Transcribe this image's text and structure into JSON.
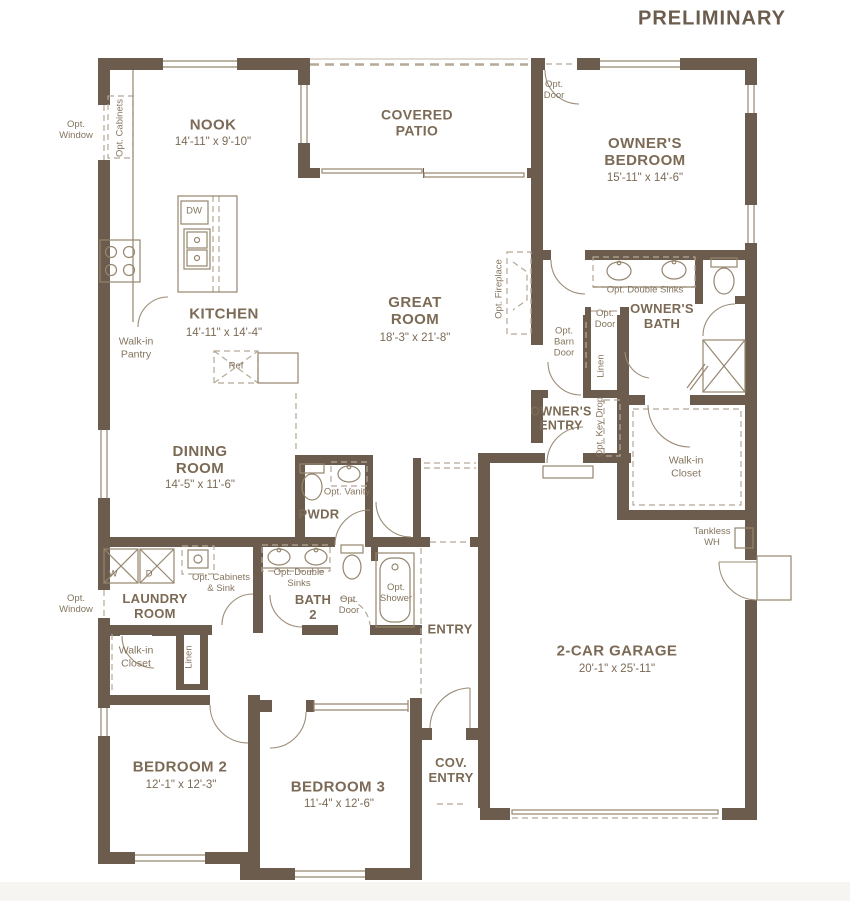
{
  "watermark": "PRELIMINARY",
  "colors": {
    "wall": "#6b5c4d",
    "line": "#95866f",
    "dashed": "#b5a896",
    "text": "#7b6a55"
  },
  "rooms": {
    "nook": {
      "name": "NOOK",
      "dims": "14'-11\" x 9'-10\""
    },
    "covered_patio": {
      "name": "COVERED\nPATIO"
    },
    "owners_bedroom": {
      "name": "OWNER'S\nBEDROOM",
      "dims": "15'-11\" x 14'-6\""
    },
    "kitchen": {
      "name": "KITCHEN",
      "dims": "14'-11\" x 14'-4\""
    },
    "great_room": {
      "name": "GREAT\nROOM",
      "dims": "18'-3\" x 21'-8\""
    },
    "owners_bath": {
      "name": "OWNER'S\nBATH"
    },
    "dining_room": {
      "name": "DINING\nROOM",
      "dims": "14'-5\" x 11'-6\""
    },
    "pwdr": {
      "name": "PWDR"
    },
    "owners_entry": {
      "name": "OWNER'S\nENTRY"
    },
    "laundry_room": {
      "name": "LAUNDRY\nROOM"
    },
    "bath_2": {
      "name": "BATH\n2"
    },
    "entry": {
      "name": "ENTRY"
    },
    "garage": {
      "name": "2-CAR GARAGE",
      "dims": "20'-1\" x 25'-11\""
    },
    "bedroom_2": {
      "name": "BEDROOM 2",
      "dims": "12'-1\" x 12'-3\""
    },
    "bedroom_3": {
      "name": "BEDROOM 3",
      "dims": "11'-4\" x 12'-6\""
    },
    "cov_entry": {
      "name": "COV.\nENTRY"
    },
    "owners_closet": {
      "name": "Walk-in\nCloset"
    },
    "hall_closet": {
      "name": "Walk-in\nCloset"
    },
    "pantry": {
      "name": "Walk-in\nPantry"
    }
  },
  "annotations": {
    "opt_window_nook": "Opt.\nWindow",
    "opt_window_laundry": "Opt.\nWindow",
    "opt_cabinets": "Opt. Cabinets",
    "opt_door_bedroom": "Opt.\nDoor",
    "opt_fireplace": "Opt. Fireplace",
    "opt_double_sinks_owners": "Opt. Double Sinks",
    "opt_door_owners_bath": "Opt.\nDoor",
    "opt_barn_door": "Opt.\nBarn\nDoor",
    "linen_owners": "Linen",
    "opt_key_drop": "Opt. Key Drop",
    "opt_vanity": "Opt. Vanity",
    "opt_cabinets_sink": "Opt. Cabinets\n& Sink",
    "opt_double_sinks_bath2": "Opt. Double\nSinks",
    "opt_door_bath2": "Opt.\nDoor",
    "opt_shower": "Opt.\nShower",
    "linen_hall": "Linen",
    "tankless_wh": "Tankless\nWH",
    "dw": "DW",
    "ref": "Ref",
    "washer": "W",
    "dryer": "D"
  }
}
